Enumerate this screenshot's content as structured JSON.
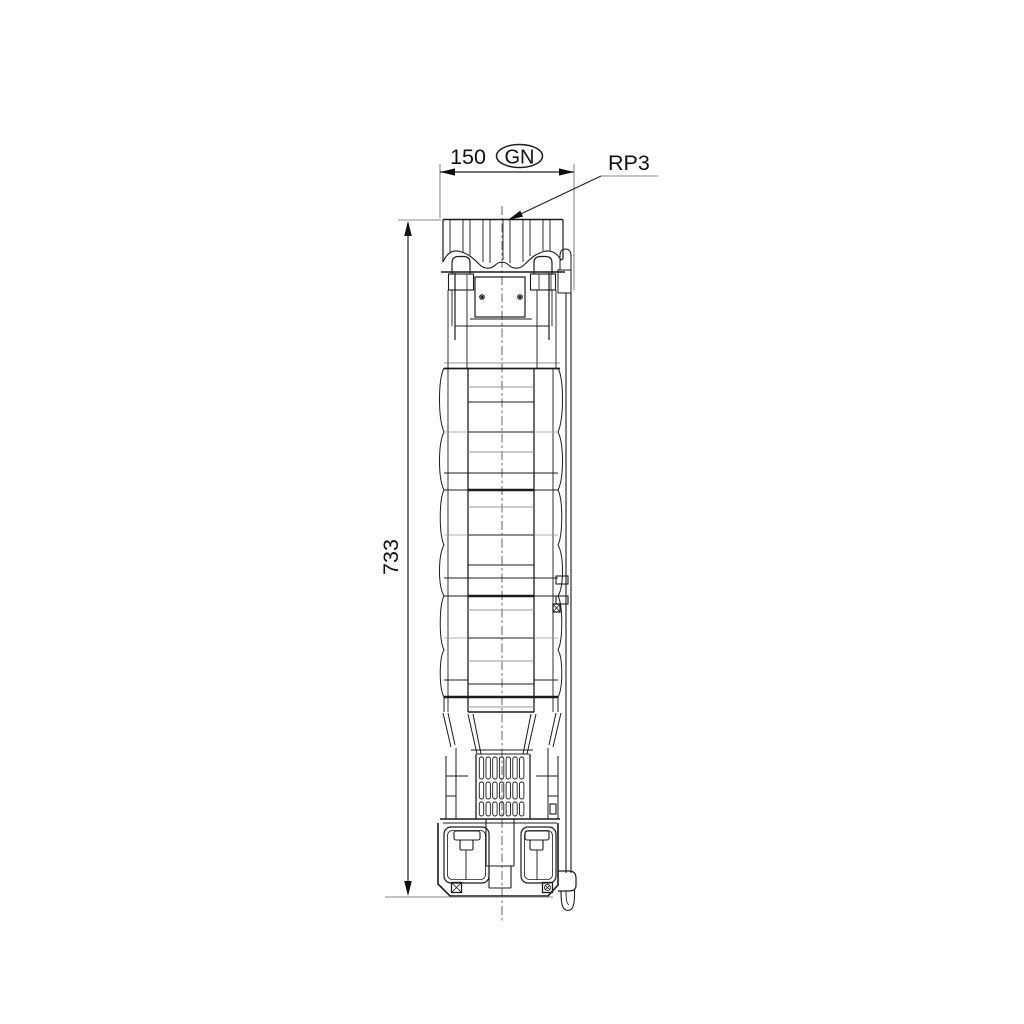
{
  "labels": {
    "width_dimension": "150",
    "width_badge": "GN",
    "height_dimension": "733",
    "connection": "RP3"
  },
  "colors": {
    "background": "#ffffff",
    "main_line": "#1c1c1c",
    "thin_gray_line": "#9a9a9a",
    "dimension_line": "#8a8a8a",
    "text": "#111111"
  }
}
